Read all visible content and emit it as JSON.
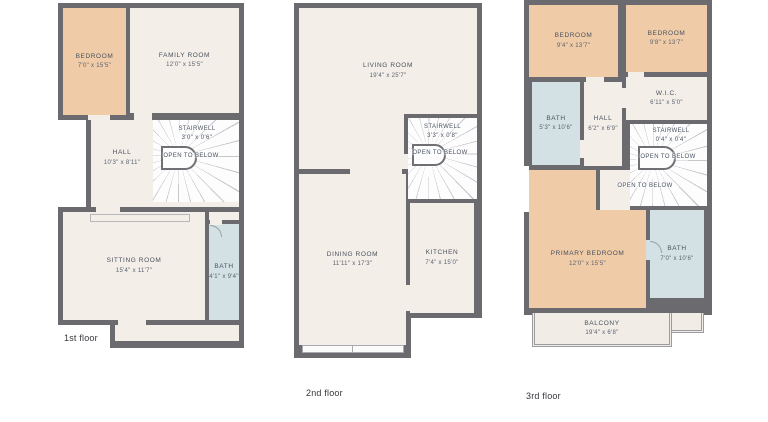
{
  "colors": {
    "wall": "#6b6a6e",
    "cream": "#f4eee8",
    "peach": "#f0cba8",
    "bath_blue": "#d3e1e4",
    "balcony": "#f1ece6",
    "stair_white": "#fdfdfe",
    "text": "#49525e"
  },
  "floors": [
    {
      "label": "1st floor",
      "rooms": {
        "bedroom": {
          "name": "BEDROOM",
          "dims": "7'0\" x 15'5\""
        },
        "family_room": {
          "name": "FAMILY ROOM",
          "dims": "12'0\" x 15'5\""
        },
        "hall": {
          "name": "HALL",
          "dims": "10'3\" x 8'11\""
        },
        "stairwell": {
          "name": "STAIRWELL",
          "dims": "3'0\" x 0'6\"",
          "note": "OPEN TO BELOW"
        },
        "sitting_room": {
          "name": "SITTING ROOM",
          "dims": "15'4\" x 11'7\""
        },
        "bath": {
          "name": "BATH",
          "dims": "4'1\" x 9'4\""
        }
      }
    },
    {
      "label": "2nd floor",
      "rooms": {
        "living_room": {
          "name": "LIVING ROOM",
          "dims": "19'4\" x 25'7\""
        },
        "stairwell": {
          "name": "STAIRWELL",
          "dims": "3'3\" x 0'8\"",
          "note": "OPEN TO BELOW"
        },
        "dining_room": {
          "name": "DINING ROOM",
          "dims": "11'11\" x 17'3\""
        },
        "kitchen": {
          "name": "KITCHEN",
          "dims": "7'4\" x 15'0\""
        }
      }
    },
    {
      "label": "3rd floor",
      "rooms": {
        "bedroom_left": {
          "name": "BEDROOM",
          "dims": "9'4\" x 13'7\""
        },
        "bedroom_right": {
          "name": "BEDROOM",
          "dims": "9'8\" x 13'7\""
        },
        "bath_top": {
          "name": "BATH",
          "dims": "5'3\" x 10'6\""
        },
        "wic": {
          "name": "W.I.C.",
          "dims": "6'11\" x 5'0\""
        },
        "hall": {
          "name": "HALL",
          "dims": "6'2\" x 6'9\""
        },
        "stairwell": {
          "name": "STAIRWELL",
          "dims": "0'4\" x 0'4\"",
          "note": "OPEN TO BELOW"
        },
        "open_below": {
          "note": "OPEN TO BELOW"
        },
        "primary_bedroom": {
          "name": "PRIMARY BEDROOM",
          "dims": "12'0\" x 15'5\""
        },
        "bath_primary": {
          "name": "BATH",
          "dims": "7'0\" x 10'6\""
        },
        "balcony": {
          "name": "BALCONY",
          "dims": "19'4\" x 6'8\""
        }
      }
    }
  ]
}
